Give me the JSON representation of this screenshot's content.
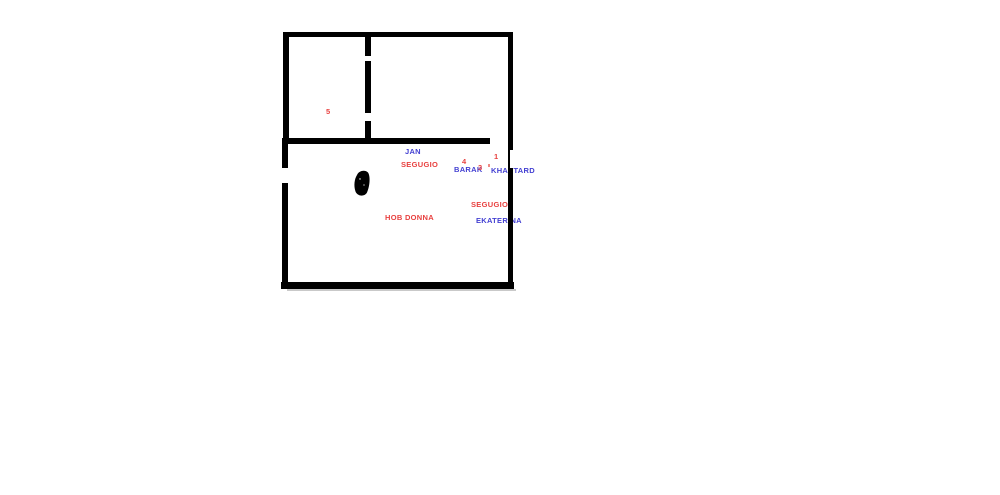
{
  "diagram": {
    "type": "hand-drawn floor plan sketch",
    "background_color": "#ffffff",
    "wall_color": "#000000",
    "shadow_color": "#c9c9c9",
    "text_colors": {
      "red": "#e8403f",
      "blue": "#4340d2"
    },
    "labels": [
      {
        "text": "5",
        "color": "red"
      },
      {
        "text": "JAN",
        "color": "blue"
      },
      {
        "text": "SEGUGIO",
        "color": "red"
      },
      {
        "text": "4",
        "color": "red"
      },
      {
        "text": "BARAK",
        "color": "blue"
      },
      {
        "text": "3",
        "color": "red"
      },
      {
        "text": "1",
        "color": "red"
      },
      {
        "text": "KHASTARD",
        "color": "blue"
      },
      {
        "text": "SEGUGIO",
        "color": "red"
      },
      {
        "text": "EKATERINA",
        "color": "blue"
      },
      {
        "text": "HOB DONNA",
        "color": "red"
      }
    ]
  }
}
